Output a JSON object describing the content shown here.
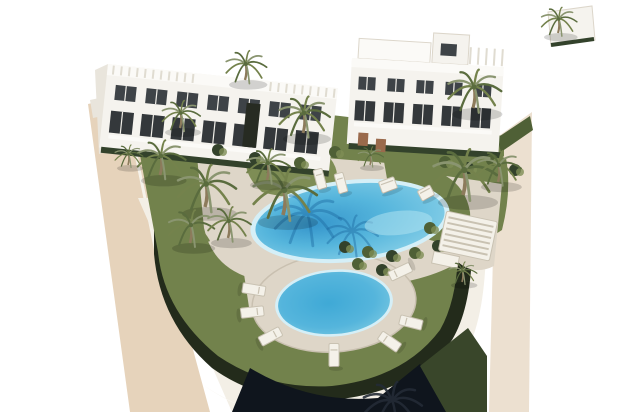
{
  "meta": {
    "description": "Aerial 3D architectural rendering of a white modern apartment complex with palm trees, lawns, a large oval swimming pool and a smaller round pool ringed by sun loungers, on a curved terraced plot edged by beige perimeter walkways on a white background.",
    "width": 640,
    "height": 412
  },
  "colors": {
    "background": "#ffffff",
    "road_left": "#e6d3bb",
    "road_right": "#ece0d0",
    "curb_light": "#f6f2ea",
    "deck": "#ded6c8",
    "deck_edge": "#c9c0b0",
    "grass": "#72824c",
    "grass_light": "#7e8d55",
    "grass_dark": "#4f6036",
    "grass_deep": "#39462a",
    "hedge_dark": "#232b1b",
    "hedge_row": "#33422b",
    "wall_white": "#f3efe6",
    "wall_shadow": "#b9b2a2",
    "pool_edge": "#d5eff7",
    "pool_light": "#8ed3e9",
    "pool_mid": "#55b5dc",
    "pool_deep": "#3595cb",
    "pool_shadow": "#1e6ca3",
    "pool_sparkle": "#b5e6f2",
    "pool_small_light": "#7fcbe2",
    "pool_small_deep": "#3fa9d6",
    "building_face": "#f5f3ee",
    "building_roof": "#fbfaf7",
    "building_side": "#e9e5dc",
    "building_side_dark": "#dcd6ca",
    "roof_grid": "#e0dcd1",
    "window_dark": "#3e4347",
    "window_deep": "#34383b",
    "mullion": "#f0eee8",
    "slot_dark": "#272b22",
    "trunk": "#8d7b5c",
    "frond_dark": "#5a6c3e",
    "frond_mid": "#74824c",
    "frond_light": "#8a9570",
    "palm_silhouette": "#232b36",
    "lounger": "#f4f1e9",
    "lounger_edge": "#c9c2b2",
    "wood": "#9a6a4c",
    "navy": "#0f151d",
    "shadow": "#000000"
  },
  "geometry": {
    "road_left": "M88,104 L124,96 L210,412 L130,412 Z",
    "road_right": "M496,138 L532,112 L529,412 L489,412 Z",
    "curb_left": [
      [
        124,
        96
      ],
      [
        156,
        252
      ]
    ],
    "wall": "M138,198 L138,252 Q144,332 202,384 Q248,418 308,419 L308,412 L232,412 Z M138,198 L486,198 L486,252 Q484,320 466,352 Q420,414 330,420 Q258,424 202,384 Q144,332 138,252 Z",
    "hedge": "M154,204 L472,204 L472,254 Q470,310 452,340 Q412,394 330,400 Q262,404 212,368 Q160,322 154,254 Z",
    "grass": "M132,112 L210,102 L340,116 L504,136 L504,156 L468,194 Q458,214 458,256 Q456,302 440,330 Q404,378 332,386 Q268,390 218,356 Q164,312 158,252 Z",
    "deck_main": "M196,146 L300,156 L425,166 Q468,176 478,202 Q486,232 468,256 Q436,280 376,286 Q298,290 250,278 Q212,266 204,228 Z",
    "deck_connector": "M244,274 L304,284 L318,330 L250,314 Z",
    "deck_right": "M446,176 L502,184 L494,266 Q474,276 458,262 Q472,240 470,212 Q466,188 446,176 Z",
    "path_topleft": "M128,108 L196,142 L198,160 L133,126 Z",
    "mound": "M248,150 Q300,142 330,158 Q344,176 330,192 Q296,202 262,192 Q240,172 248,150 Z",
    "lawn_right": "M382,150 Q450,144 506,158 Q512,190 502,230 Q470,252 430,240 Q400,224 390,196 Z",
    "hedge_right_top": "M497,138 L530,116 L533,130 L501,152 Z",
    "navy_wedge": "M232,412 L250,368 Q310,404 378,398 L420,364 L454,412 Z",
    "olive_wedge": "M420,366 L468,328 L487,356 L487,412 L446,412 Z",
    "farleft_wall": "M90,100 L118,94 L121,112 L93,118 Z"
  },
  "pools": {
    "big": {
      "cx": 350,
      "cy": 221,
      "rx": 95,
      "ry": 37,
      "rot": -6
    },
    "small": {
      "cx": 334,
      "cy": 303,
      "rx": 56,
      "ry": 31,
      "rot": -4,
      "deck_rx": 82,
      "deck_ry": 49
    },
    "shadow_fans": [
      [
        307,
        214,
        1.3
      ],
      [
        352,
        232,
        1.0
      ]
    ],
    "sparkle": [
      398,
      228,
      34,
      12
    ]
  },
  "palms": [
    [
      160,
      175,
      0.95
    ],
    [
      180,
      128,
      0.75
    ],
    [
      205,
      207,
      1.15
    ],
    [
      283,
      215,
      1.25
    ],
    [
      303,
      133,
      1.0
    ],
    [
      267,
      180,
      0.85
    ],
    [
      245,
      80,
      0.8
    ],
    [
      473,
      108,
      1.05
    ],
    [
      463,
      195,
      1.25
    ],
    [
      498,
      182,
      0.85
    ],
    [
      190,
      243,
      0.9
    ],
    [
      228,
      238,
      0.85
    ],
    [
      462,
      282,
      0.55
    ],
    [
      558,
      33,
      0.7
    ],
    [
      370,
      165,
      0.5
    ],
    [
      128,
      165,
      0.55
    ]
  ],
  "palm_bottom": [
    392,
    424,
    1.15
  ],
  "bushes": [
    [
      345,
      247
    ],
    [
      368,
      252
    ],
    [
      392,
      256
    ],
    [
      415,
      253
    ],
    [
      438,
      246
    ],
    [
      300,
      163
    ],
    [
      255,
      158
    ],
    [
      445,
      162
    ],
    [
      468,
      168
    ],
    [
      492,
      160
    ],
    [
      515,
      170
    ],
    [
      430,
      228
    ],
    [
      218,
      150
    ],
    [
      358,
      264
    ],
    [
      382,
      270
    ],
    [
      335,
      152
    ]
  ],
  "loungers": {
    "ring": {
      "cx": 334,
      "cy": 303,
      "rx": 83,
      "ry": 52,
      "angles": [
        195,
        170,
        140,
        90,
        48,
        22,
        323
      ]
    },
    "flat": [
      [
        320,
        179,
        -15,
        9,
        20
      ],
      [
        341,
        183,
        -15,
        9,
        20
      ],
      [
        388,
        185,
        -20,
        16,
        12
      ],
      [
        426,
        193,
        -28,
        14,
        11
      ]
    ]
  },
  "pergola": {
    "x": 468,
    "y": 236,
    "rot": 12,
    "w": 52,
    "h": 40,
    "slats": 6,
    "box": [
      -30,
      22,
      26,
      12
    ]
  },
  "buildings": {
    "left": {
      "rotate": 6,
      "ox": 108,
      "oy": 64,
      "w": 231,
      "h": 84,
      "side": "M95,70 L108,64 L112,150 L99,154 Z",
      "win_row1": {
        "y": 84,
        "x0": 118,
        "step": 31,
        "n": 7,
        "w": 21,
        "h": 15
      },
      "win_row2": {
        "y": 110,
        "x0": 116,
        "step": 31,
        "n": 7,
        "w": 23,
        "h": 22
      },
      "roof_grids": [
        [
          114,
          200
        ],
        [
          272,
          336
        ]
      ],
      "slot": [
        250,
        88,
        14,
        44
      ],
      "hedge_y": 150
    },
    "right": {
      "rotate": 3.5,
      "ox": 352,
      "oy": 58,
      "w": 152,
      "h": 86,
      "rooftop_slab": [
        358,
        38,
        72,
        20
      ],
      "rooftop_box": [
        432,
        28,
        36,
        30
      ],
      "box_opening": [
        440,
        38,
        16,
        12
      ],
      "roof_grid": [
        470,
        502
      ],
      "win_row1": {
        "y": 76,
        "x0": 360,
        "step": 29,
        "n": 5,
        "w": 17,
        "h": 13
      },
      "win_row2": {
        "y": 100,
        "x0": 358,
        "step": 29,
        "n": 5,
        "w": 20,
        "h": 20
      },
      "hedge_y": 146,
      "planters": [
        [
          363,
          132
        ],
        [
          381,
          137
        ]
      ]
    },
    "fragment": {
      "path": "M548,12 L592,6 L595,40 L551,46 Z",
      "hedge": [
        [
          551,
          45
        ],
        [
          594,
          39
        ]
      ]
    }
  }
}
